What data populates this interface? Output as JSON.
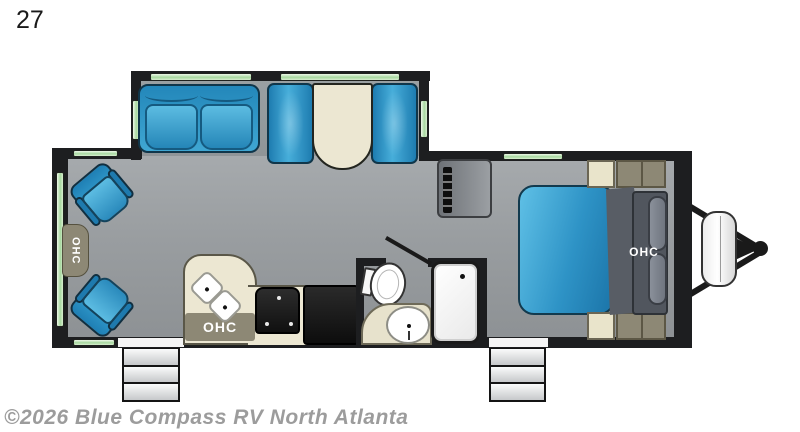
{
  "floorplan": {
    "model_label": "27",
    "watermark": "©2026 Blue Compass RV North Atlanta",
    "labels": {
      "ohc_rear": "OHC",
      "ohc_kitchen": "OHC",
      "ohc_bedroom": "OHC"
    },
    "colors": {
      "wall": "#1d1e20",
      "floor_gray": "#999da0",
      "window_green": "#a8d9a0",
      "furniture_blue": "#2e93c6",
      "counter_cream": "#ece7d2",
      "cabinet_olive": "#8d8875",
      "fixture_white": "#ffffff",
      "watermark_gray": "#9c9c9c"
    },
    "fixtures": [
      "theater-chairs",
      "rear-overhead-cabinet",
      "sofa",
      "booth-dinette",
      "kitchen-double-sink",
      "range-stove",
      "refrigerator",
      "kitchen-overhead-cabinet",
      "toilet",
      "vanity-sink",
      "tub-shower",
      "wardrobe-tv",
      "queen-bed",
      "bedroom-overhead-cabinet",
      "nightstands",
      "entry-steps-main",
      "entry-steps-bedroom",
      "propane-tank",
      "a-frame-hitch"
    ]
  }
}
